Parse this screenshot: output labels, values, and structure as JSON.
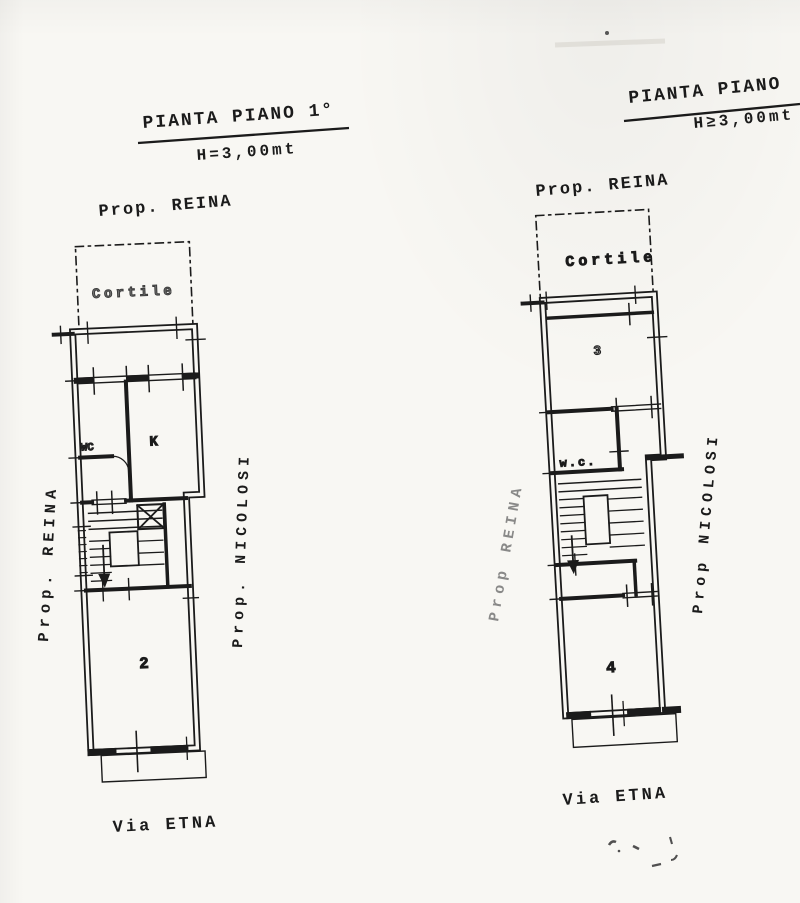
{
  "document_type": "scanned floor plan drawing",
  "colors": {
    "paper": "#f8f7f3",
    "ink": "#1b1b1b"
  },
  "left_plan": {
    "title": "PIANTA PIANO  1°",
    "height_note": "H=3,00mt",
    "top_property_label": "Prop. REINA",
    "courtyard_label": "Cortile",
    "side_left_label": "Prop. REINA",
    "side_right_label": "Prop. NICOLOSI",
    "street_label": "Via ETNA",
    "rooms": {
      "wc": "WC",
      "kitchen": "K",
      "room": "2"
    }
  },
  "right_plan": {
    "title": "PIANTA PIANO",
    "height_note": "H≥3,00mt",
    "top_property_label": "Prop. REINA",
    "courtyard_label": "Cortile",
    "side_left_label": "Prop REINA",
    "side_right_label": "Prop NICOLOSI",
    "street_label": "Via ETNA",
    "rooms": {
      "wc": "w.c.",
      "room_top": "3",
      "room_bottom": "4"
    }
  }
}
